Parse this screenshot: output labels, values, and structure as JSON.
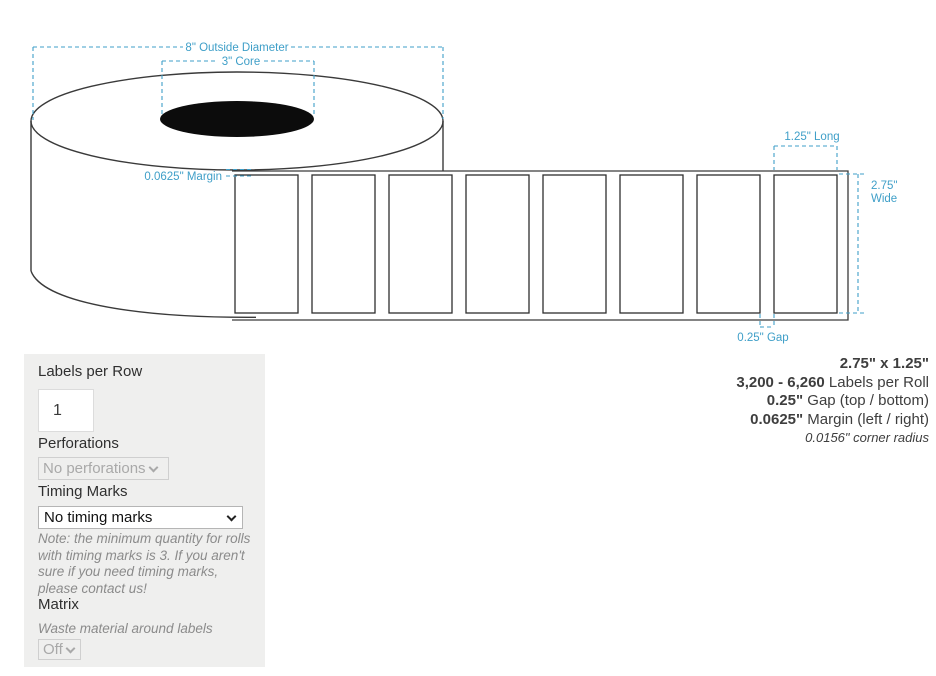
{
  "diagram": {
    "outside_diameter_label": "8\" Outside Diameter",
    "core_label": "3\" Core",
    "margin_label": "0.0625\" Margin",
    "long_label": "1.25\" Long",
    "wide_label_line1": "2.75\"",
    "wide_label_line2": "Wide",
    "gap_label": "0.25\" Gap",
    "label_count": 8,
    "colors": {
      "annotation_blue": "#3f9fc8",
      "outline_dark": "#3a3a3a",
      "core_black": "#0c0c0c"
    }
  },
  "form": {
    "labels_per_row": {
      "label": "Labels per Row",
      "value": "1"
    },
    "perforations": {
      "label": "Perforations",
      "selected": "No perforations"
    },
    "timing_marks": {
      "label": "Timing Marks",
      "selected": "No timing marks",
      "note": "Note: the minimum quantity for rolls with timing marks is 3. If you aren't sure if you need timing marks, please contact us!"
    },
    "matrix": {
      "label": "Matrix",
      "description": "Waste material around labels",
      "selected": "Off"
    }
  },
  "specs": {
    "size": "2.75\" x 1.25\"",
    "labels_per_roll_value": "3,200 - 6,260",
    "labels_per_roll_suffix": " Labels per Roll",
    "gap_value": "0.25\"",
    "gap_suffix": " Gap (top / bottom)",
    "margin_value": "0.0625\"",
    "margin_suffix": " Margin (left / right)",
    "corner_radius": "0.0156\" corner radius"
  }
}
